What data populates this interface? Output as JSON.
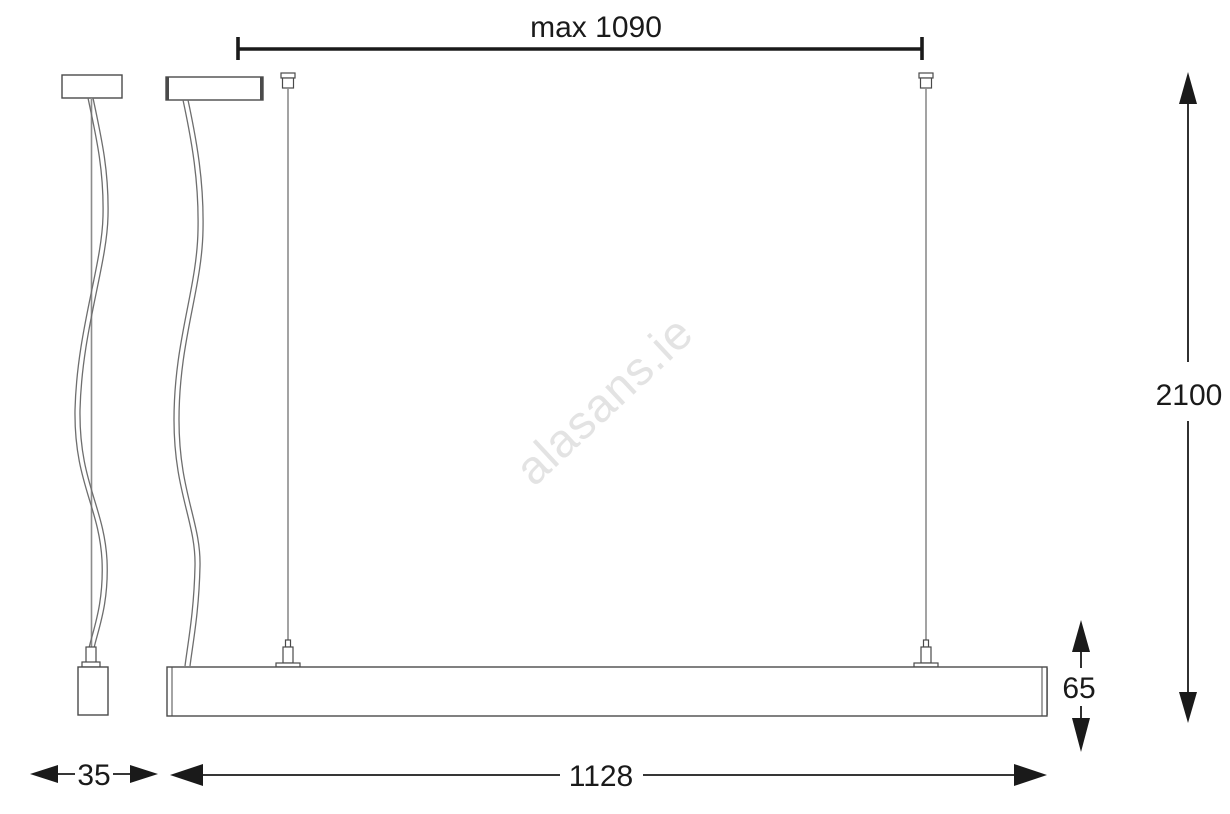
{
  "colors": {
    "bg": "#ffffff",
    "ink": "#1a1a1a",
    "outline": "#4a4a4a",
    "shade": "#aaaaaa",
    "cable": "#6e6e6e",
    "wire": "#8c8c8c",
    "watermark": "#e3e3e3"
  },
  "watermark": {
    "text": "alasans.ie"
  },
  "dimensions": {
    "max_suspension": {
      "label": "max 1090"
    },
    "overall_drop": {
      "label": "2100"
    },
    "bar_height": {
      "label": "65"
    },
    "bar_depth": {
      "label": "35"
    },
    "bar_length": {
      "label": "1128"
    }
  }
}
